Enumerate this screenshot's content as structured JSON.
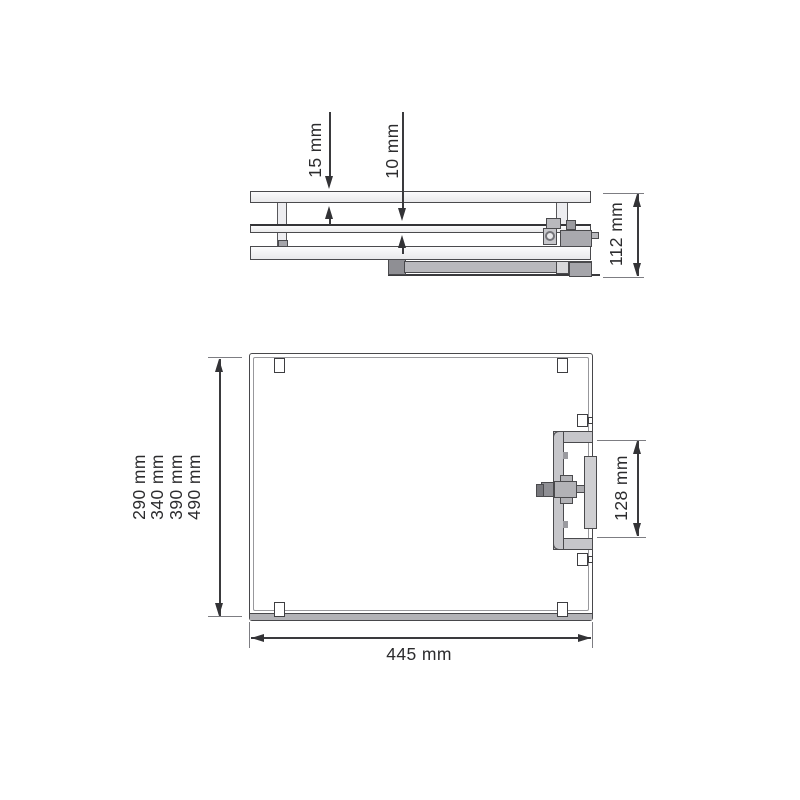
{
  "drawing": {
    "title": "pull-out frame dimension drawing",
    "side_view": {
      "top_shelf_thickness": "15 mm",
      "mid_shelf_thickness": "10 mm",
      "total_height": "112 mm"
    },
    "plan_view": {
      "depth_options": [
        "290 mm",
        "340 mm",
        "390 mm",
        "490 mm"
      ],
      "width": "445 mm",
      "bracket_length": "128 mm"
    },
    "colors": {
      "line": "#3a3a3d",
      "outline": "#4a4a4d",
      "light_fill": "#ededf0",
      "mid_fill": "#b9b9bd",
      "dark_fill": "#8f8f94",
      "background": "#ffffff"
    }
  }
}
